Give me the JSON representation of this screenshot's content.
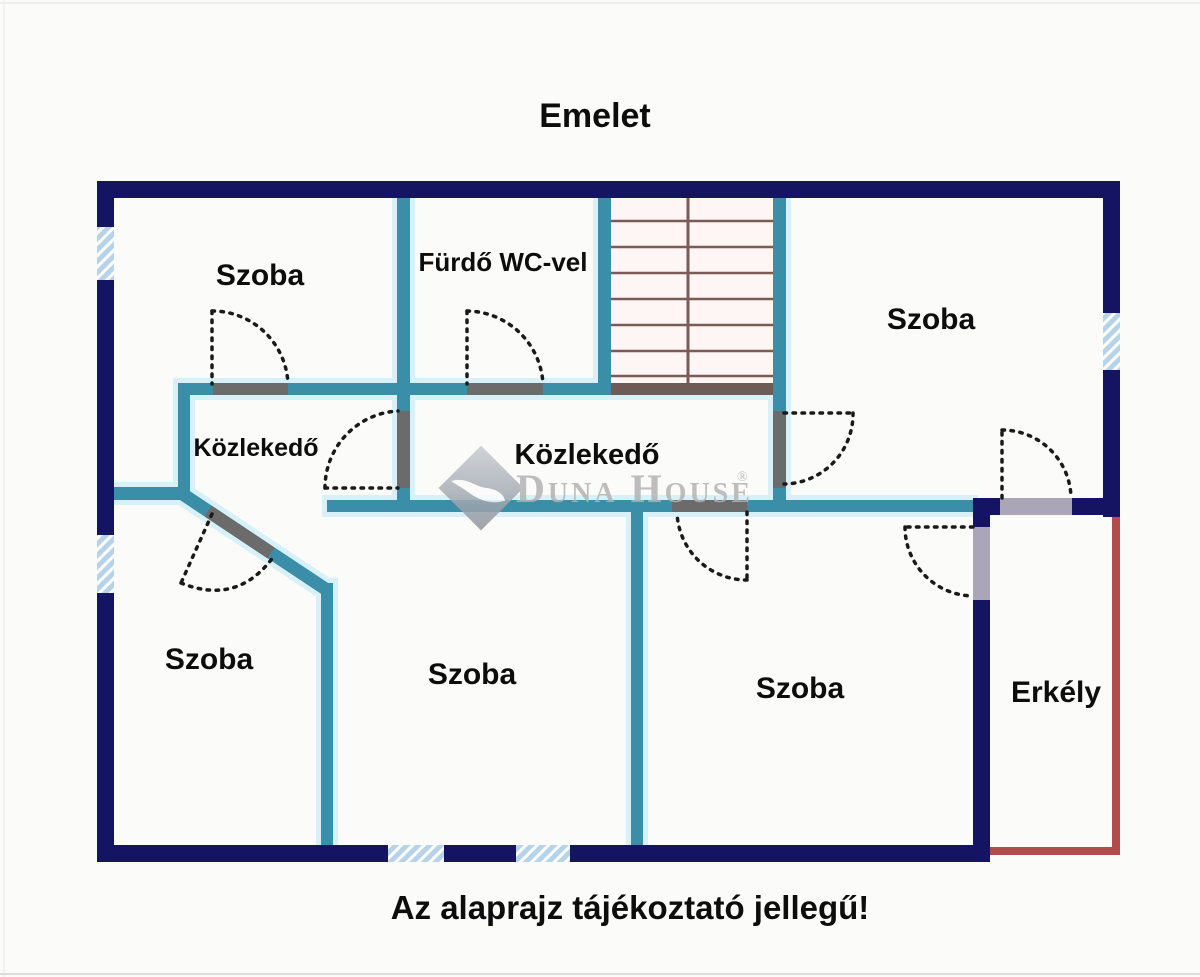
{
  "page": {
    "title": "Emelet",
    "caption": "Az alaprajz tájékoztató jellegű!"
  },
  "rooms": {
    "szoba_top_left": "Szoba",
    "furdo": "Fürdő WC-vel",
    "szoba_top_right": "Szoba",
    "kozlekedo_small": "Közlekedő",
    "kozlekedo_main": "Közlekedő",
    "szoba_bottom_left": "Szoba",
    "szoba_bottom_center": "Szoba",
    "szoba_bottom_right": "Szoba",
    "erkely": "Erkély"
  },
  "watermark": {
    "brand": "Duna House",
    "registered": "®"
  },
  "colors": {
    "outer_wall": "#141463",
    "inner_wall": "#3a8ea8",
    "wall_glow": "#d8f1f9",
    "window_fill": "#b7d3e9",
    "window_stripe": "#ffffff",
    "balcony_wall": "#b24c4c",
    "stair_line": "#7c5a56",
    "door_threshold": "#6b6b6b",
    "balcony_threshold": "#aaa6b8",
    "label_text": "#0d0d0d",
    "watermark_gray": "#b3b3b5",
    "background": "#fbfbf9"
  }
}
